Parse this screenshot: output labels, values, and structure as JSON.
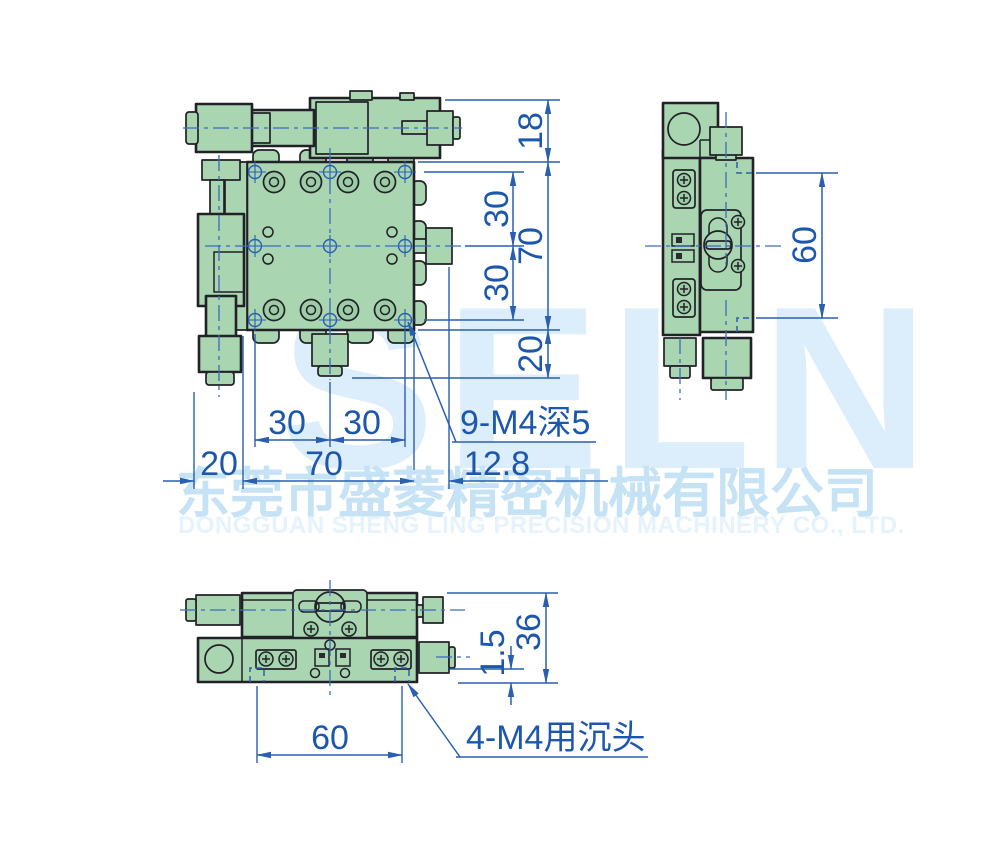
{
  "drawing": {
    "title": "XY precision stage 3-view technical drawing",
    "watermark": {
      "logo": "SELN",
      "company_cn": "东莞市盛菱精密机械有限公司",
      "company_en": "DONGGUAN SHENG LING PRECISION MACHINERY CO., LTD."
    },
    "top_view": {
      "dims": {
        "d18": "18",
        "d30_upper_right": "30",
        "d70_right": "70",
        "d30_lower_right": "30",
        "d20_right": "20",
        "d30_bottom_left": "30",
        "d30_bottom_right": "30",
        "d20_bottom": "20",
        "d70_bottom": "70",
        "d12_8": "12.8",
        "note_tapped_holes": "9-M4深5"
      }
    },
    "side_view": {
      "dims": {
        "d60": "60"
      }
    },
    "front_view": {
      "dims": {
        "d36": "36",
        "d1_5": "1.5",
        "d60": "60",
        "note_counterbores": "4-M4用沉头"
      }
    },
    "colors": {
      "body_green": "#a9d5b1",
      "body_green_dark": "#9ccda6",
      "outline_dark": "#212127",
      "dim_line_blue": "#2a5fb0",
      "dim_text_blue": "#1d57ad",
      "centerline_blue": "#3a6cc0",
      "watermark_logo_blue": "#dceefb",
      "watermark_cn_blue": "#c6e2f5",
      "watermark_en_blue": "#e6f3fc",
      "background": "#ffffff"
    }
  }
}
